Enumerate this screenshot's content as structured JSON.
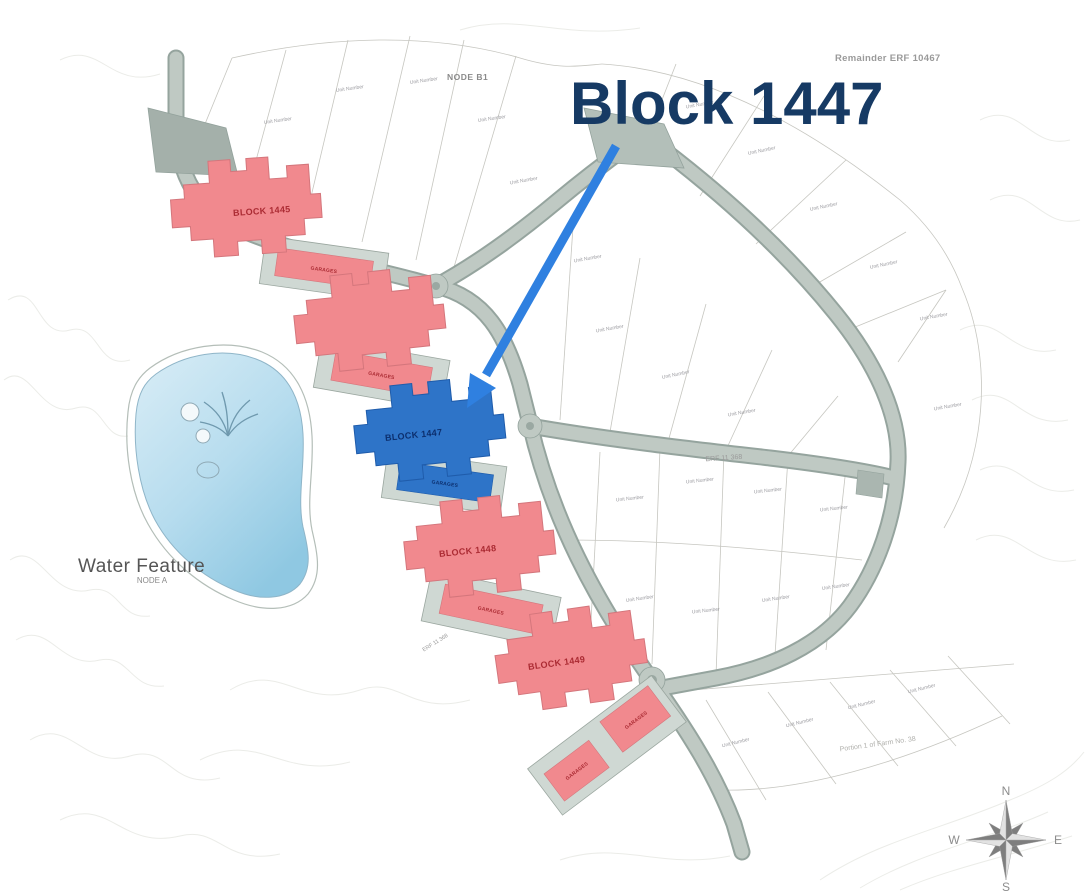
{
  "title": "Block 1447",
  "map_labels": {
    "node_b1": "NODE B1",
    "remainder_erf": "Remainder ERF 10467",
    "water_feature": "Water Feature",
    "node_a": "NODE A",
    "erf_11368": "ERF 11 368",
    "portion_farm": "Portion 1 of Farm No. 38",
    "unit_number": "Unit Number"
  },
  "blocks": {
    "block_1445": "BLOCK 1445",
    "block_1447": "BLOCK 1447",
    "block_1448": "BLOCK 1448",
    "block_1449": "BLOCK 1449",
    "garages": "GARAGES"
  },
  "compass": {
    "north": "N",
    "east": "E",
    "south": "S",
    "west": "W"
  },
  "colors": {
    "title": "#163a64",
    "arrow": "#2f80e0",
    "block_pink": "#f1898e",
    "block_blue": "#2e74c8",
    "block_label_red": "#ab2b33",
    "block_label_blue": "#0c2f6e",
    "water": "#aed6ea",
    "road": "#bfc9c3"
  }
}
